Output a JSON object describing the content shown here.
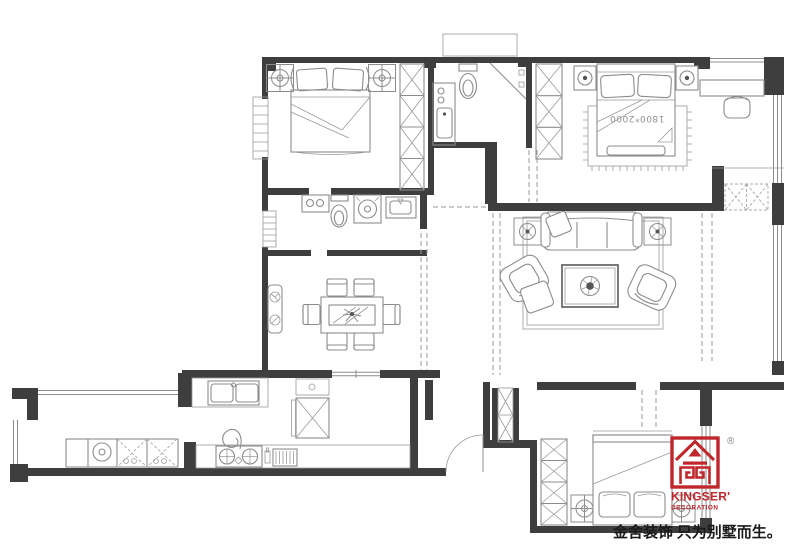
{
  "plan": {
    "master_bed_label": "1800*2000",
    "legend": [
      "double-bed",
      "pillow",
      "wardrobe",
      "ceiling-light",
      "nightstand-lamp",
      "rug",
      "toilet",
      "washbasin",
      "shower",
      "washing-machine",
      "laundry-counter",
      "dining-table",
      "dining-chair",
      "sideboard-with-plants",
      "sofa",
      "armchair",
      "ottoman",
      "coffee-table-with-plant",
      "side-table-with-plant",
      "desk",
      "desk-chair",
      "storage-cabinet",
      "duct-shaft",
      "kitchen-sink",
      "refrigerator",
      "gas-stove",
      "range-rack",
      "balcony-cabinets",
      "window",
      "door-opening",
      "entry-door-swing"
    ]
  },
  "watermark": {
    "brand": "KINGSER'",
    "subtitle": "DECORATION",
    "registered_mark": "®",
    "slogan": "金舍装饰 只为别墅而生。",
    "brand_color": "#c0272b",
    "registered_color": "#8a8a8a",
    "slogan_color": "#1a1a1a"
  },
  "palette": {
    "background": "#ffffff",
    "wall": "#3e3e3e",
    "line": "#8c8c8c"
  }
}
